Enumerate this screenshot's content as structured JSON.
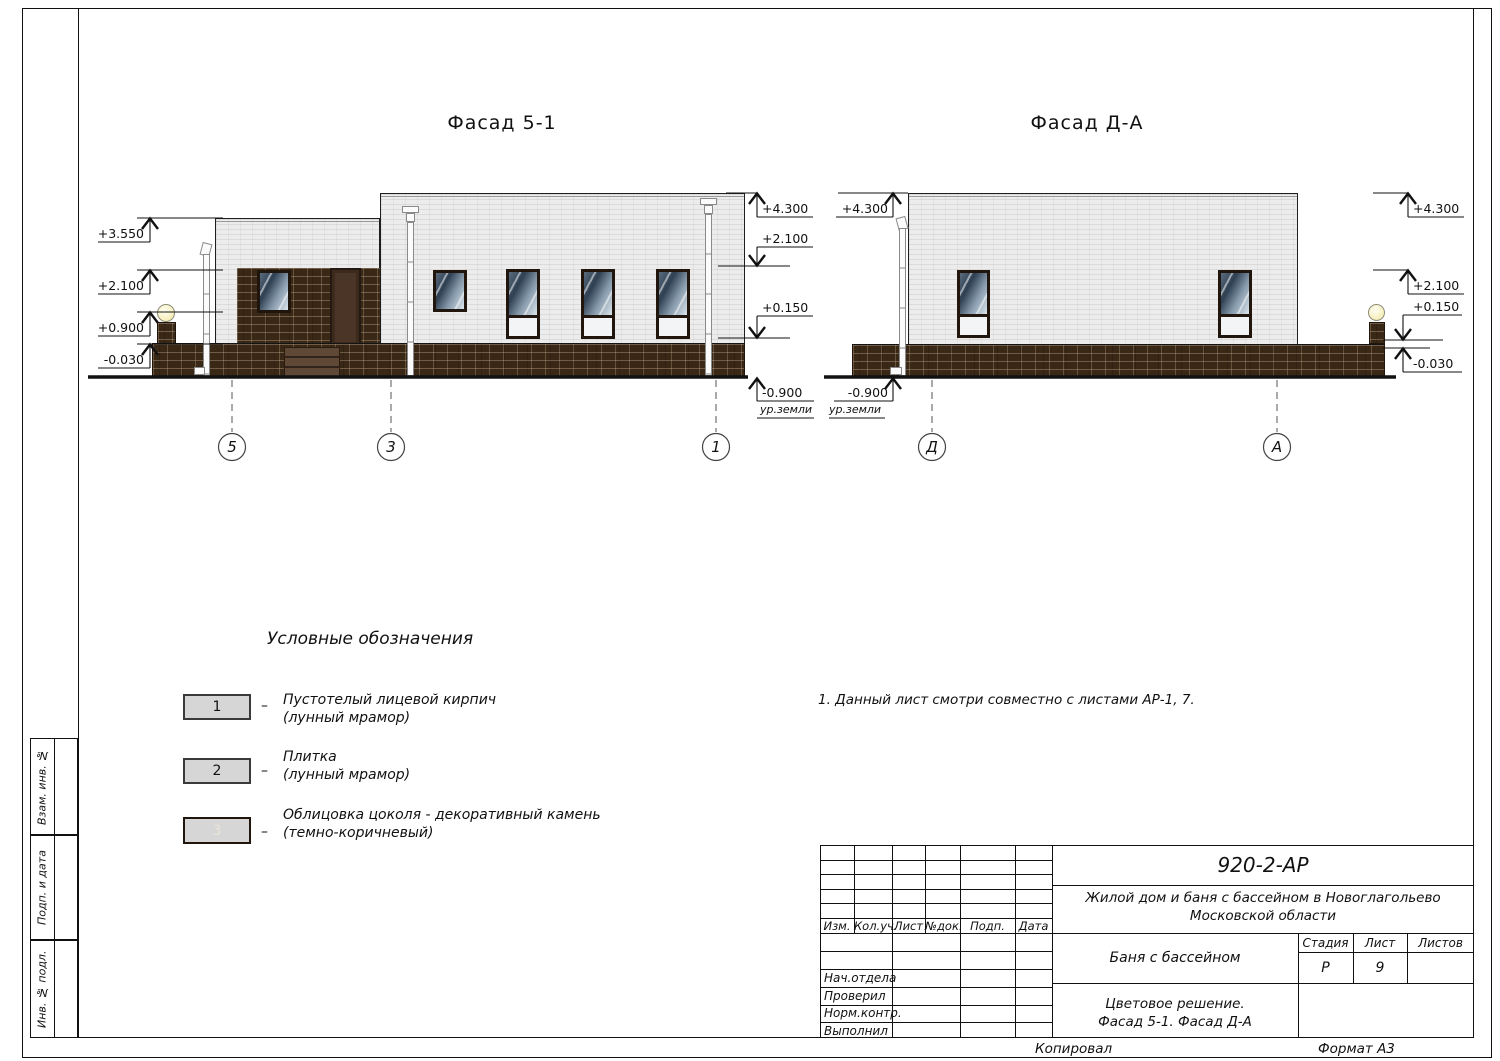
{
  "colors": {
    "wall_brick": "#ececec",
    "plinth_stone": "#3a2817",
    "door_brown": "#4a3526",
    "glass_dark": "#2f4053",
    "swatch_gray": "#d6d6d6",
    "lamp_glow": "#f6efbe"
  },
  "facades": {
    "left": {
      "title": "Фасад 5-1",
      "axes": [
        "5",
        "3",
        "1"
      ],
      "marks_left": [
        "+3.550",
        "+2.100",
        "+0.900",
        "-0.030"
      ],
      "marks_right": [
        "+4.300",
        "+2.100",
        "+0.150",
        "-0.900"
      ],
      "ground_label": "ур.земли"
    },
    "right": {
      "title": "Фасад Д-А",
      "axes": [
        "Д",
        "А"
      ],
      "marks_left": [
        "+4.300",
        "-0.900"
      ],
      "marks_right": [
        "+4.300",
        "+2.100",
        "+0.150",
        "-0.030"
      ],
      "ground_label": "ур.земли"
    }
  },
  "legend": {
    "title": "Условные обозначения",
    "separator": "–",
    "items": [
      {
        "num": "1",
        "line1": "Пустотелый лицевой кирпич",
        "line2": "(лунный мрамор)"
      },
      {
        "num": "2",
        "line1": "Плитка",
        "line2": "(лунный мрамор)"
      },
      {
        "num": "3",
        "line1": "Облицовка цоколя - декоративный камень",
        "line2": "(темно-коричневый)"
      }
    ]
  },
  "note": "1. Данный лист смотри совместно с листами АР-1, 7.",
  "titleblock": {
    "doc_number": "920-2-АР",
    "project_line1": "Жилой дом и баня с бассейном в Новоглагольево",
    "project_line2": "Московской области",
    "object_name": "Баня с бассейном",
    "sheet_title_line1": "Цветовое решение.",
    "sheet_title_line2": "Фасад 5-1. Фасад Д-А",
    "header_cols": [
      "Изм.",
      "Кол.уч.",
      "Лист",
      "№док.",
      "Подп.",
      "Дата"
    ],
    "row_labels": [
      "Нач.отдела",
      "Проверил",
      "Норм.контр.",
      "Выполнил"
    ],
    "stage_label": "Стадия",
    "sheet_label": "Лист",
    "sheets_label": "Листов",
    "stage_value": "Р",
    "sheet_value": "9",
    "sheets_value": ""
  },
  "side_strip": {
    "labels": [
      "Взам. инв. №",
      "Подп. и дата",
      "Инв. № подл."
    ]
  },
  "footer": {
    "left": "Копировал",
    "right": "Формат А3"
  }
}
